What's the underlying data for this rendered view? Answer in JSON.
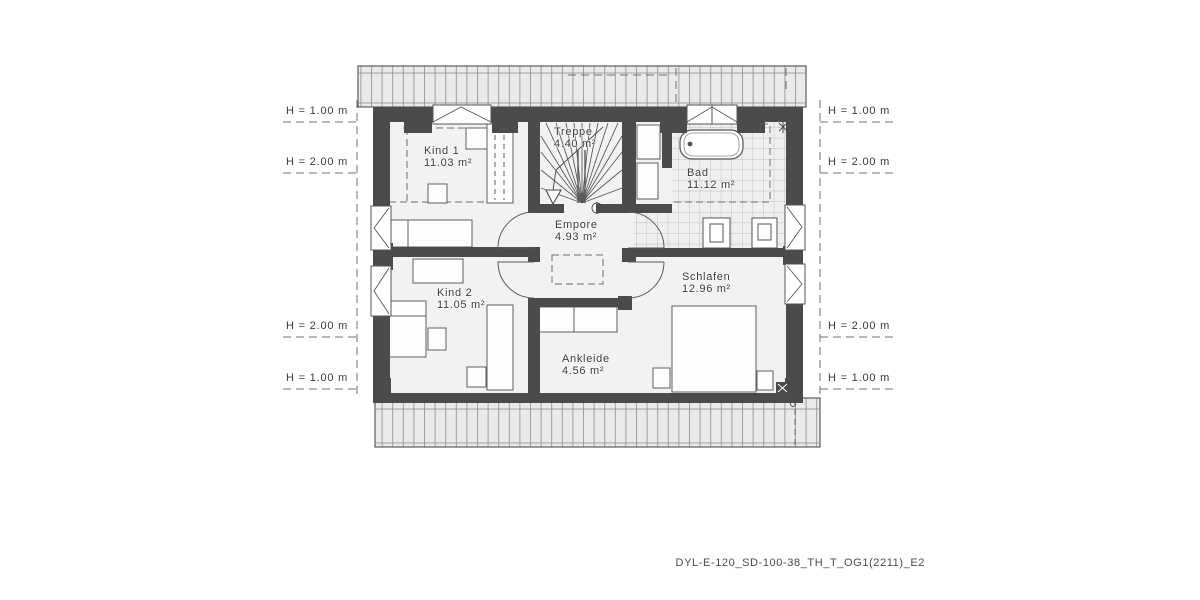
{
  "plan": {
    "rooms": {
      "kind1": {
        "name": "Kind 1",
        "area": "11.03 m²"
      },
      "treppe": {
        "name": "Treppe",
        "area": "4.40 m²"
      },
      "bad": {
        "name": "Bad",
        "area": "11.12 m²"
      },
      "empore": {
        "name": "Empore",
        "area": "4.93 m²"
      },
      "kind2": {
        "name": "Kind 2",
        "area": "11.05 m²"
      },
      "schlafen": {
        "name": "Schlafen",
        "area": "12.96 m²"
      },
      "ankleide": {
        "name": "Ankleide",
        "area": "4.56 m²"
      }
    },
    "height_marks": {
      "h100": "H = 1.00 m",
      "h200": "H = 2.00 m"
    },
    "drawing_code": "DYL-E-120_SD-100-38_TH_T_OG1(2211)_E2",
    "colors": {
      "wall": "#494b4d",
      "roof_overhang_fill": "#eaeaea",
      "floor": "#f2f2f2",
      "tile_line": "#bcbcbc",
      "annotation": "#6f6f6f",
      "text": "#3b3b3b"
    }
  }
}
